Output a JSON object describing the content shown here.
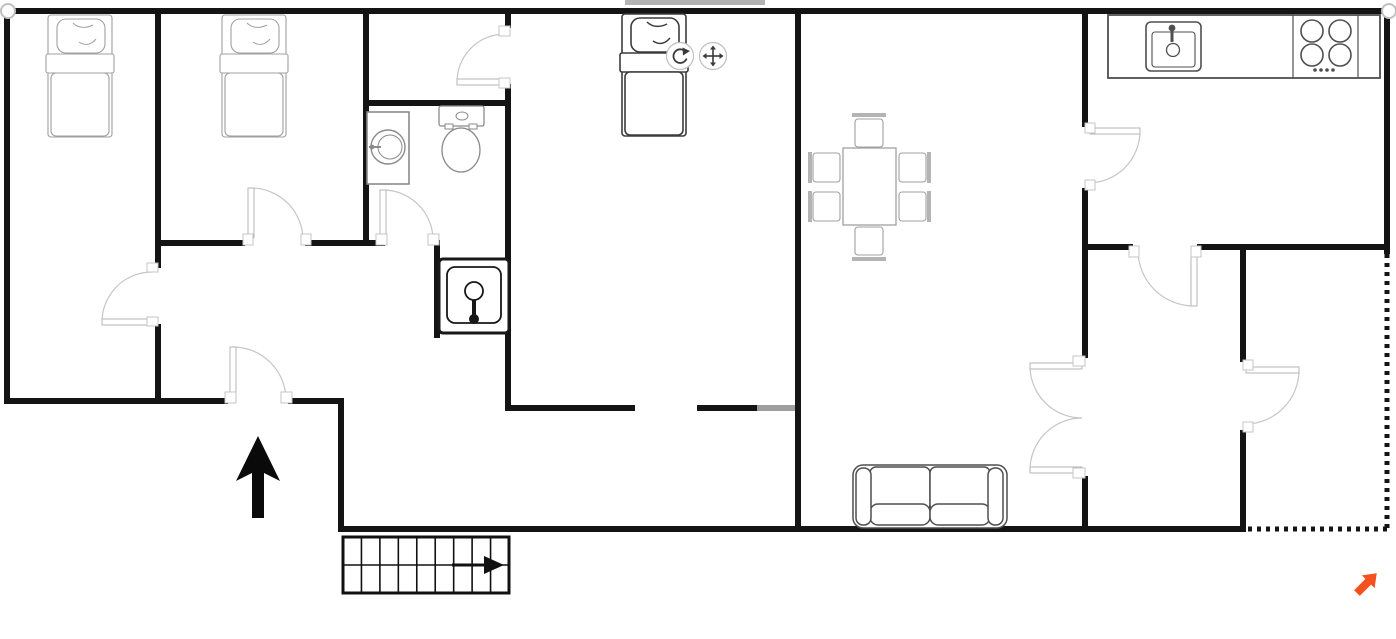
{
  "canvas": {
    "width": 1396,
    "height": 639,
    "bg": "#ffffff"
  },
  "colors": {
    "wall": "#141414",
    "wall_opening_tint": "#9e9e9e",
    "selected_bar_tint": "#b3b3b3",
    "door_arc": "#c6c6c6",
    "door_leaf_stroke": "#b5b5b5",
    "jamb_stroke": "#c4c4c4",
    "furniture_light": "#a0a0a0",
    "furniture_mid": "#8a8a8a",
    "furniture_dark": "#4f4f4f",
    "chair_back_fill": "#b4b4b4",
    "selected_stroke": "#3c3c3c",
    "dark_item": "#181818",
    "stairs": "#111111",
    "north": "#0a0a0a",
    "handle_stroke": "#c0c0c0",
    "icon_glyph": "#3a3a3a",
    "accent_orange": "#f4511e",
    "white": "#ffffff"
  },
  "walls": {
    "solid": [
      [
        4,
        8,
        1388,
        6
      ],
      [
        4,
        8,
        6,
        396
      ],
      [
        4,
        398,
        224,
        6
      ],
      [
        288,
        398,
        56,
        6
      ],
      [
        338,
        398,
        6,
        134
      ],
      [
        338,
        526,
        908,
        6
      ],
      [
        1384,
        8,
        6,
        246
      ],
      [
        155,
        8,
        6,
        260
      ],
      [
        155,
        324,
        6,
        80
      ],
      [
        155,
        240,
        90,
        6
      ],
      [
        305,
        240,
        63,
        6
      ],
      [
        363,
        8,
        6,
        238
      ],
      [
        363,
        100,
        148,
        6
      ],
      [
        505,
        8,
        6,
        20
      ],
      [
        505,
        84,
        6,
        327
      ],
      [
        363,
        240,
        22,
        6
      ],
      [
        434,
        240,
        6,
        98
      ],
      [
        505,
        405,
        130,
        6
      ],
      [
        697,
        405,
        60,
        6
      ],
      [
        795,
        8,
        6,
        524
      ],
      [
        1082,
        8,
        6,
        119
      ],
      [
        1082,
        188,
        6,
        170
      ],
      [
        1082,
        476,
        6,
        56
      ],
      [
        1082,
        244,
        51,
        6
      ],
      [
        1197,
        244,
        193,
        6
      ],
      [
        1240,
        244,
        6,
        118
      ],
      [
        1240,
        430,
        6,
        102
      ]
    ],
    "tinted": [
      {
        "rect": [
          757,
          405,
          38,
          6
        ],
        "color": "#9e9e9e"
      },
      {
        "rect": [
          625,
          0,
          140,
          5
        ],
        "color": "#b3b3b3"
      }
    ],
    "dotted": [
      {
        "x1": 1387,
        "y1": 254,
        "x2": 1387,
        "y2": 529
      },
      {
        "x1": 1248,
        "y1": 529,
        "x2": 1392,
        "y2": 529
      }
    ],
    "endpoint_handles": [
      [
        8,
        11
      ],
      [
        1389,
        11
      ]
    ]
  },
  "doors": [
    {
      "id": "door-bedroom-1",
      "leaf": [
        102,
        322,
        152,
        322
      ],
      "arc": {
        "from": [
          102,
          322
        ],
        "to": [
          152,
          272
        ],
        "r": 50,
        "sweep": 1
      },
      "jambs": [
        [
          147,
          263,
          11,
          9
        ],
        [
          147,
          317,
          11,
          9
        ]
      ]
    },
    {
      "id": "door-bedroom-2",
      "leaf": [
        251,
        188,
        251,
        238
      ],
      "arc": {
        "from": [
          251,
          188
        ],
        "to": [
          303,
          240
        ],
        "r": 52,
        "sweep": 1
      },
      "jambs": [
        [
          243,
          234,
          10,
          11
        ],
        [
          301,
          234,
          10,
          11
        ]
      ]
    },
    {
      "id": "door-entrance",
      "leaf": [
        233,
        347,
        233,
        398
      ],
      "arc": {
        "from": [
          233,
          347
        ],
        "to": [
          286,
          400
        ],
        "r": 53,
        "sweep": 1
      },
      "jambs": [
        [
          225,
          392,
          11,
          11
        ],
        [
          281,
          392,
          11,
          11
        ]
      ]
    },
    {
      "id": "door-bathroom",
      "leaf": [
        383,
        190,
        383,
        238
      ],
      "arc": {
        "from": [
          383,
          190
        ],
        "to": [
          433,
          240
        ],
        "r": 50,
        "sweep": 1
      },
      "jambs": [
        [
          376,
          234,
          11,
          11
        ],
        [
          428,
          234,
          11,
          11
        ]
      ]
    },
    {
      "id": "door-closet",
      "leaf": [
        457,
        82,
        504,
        82
      ],
      "arc": {
        "from": [
          457,
          82
        ],
        "to": [
          505,
          34
        ],
        "r": 48,
        "sweep": 1
      },
      "jambs": [
        [
          499,
          26,
          11,
          10
        ],
        [
          499,
          78,
          11,
          10
        ]
      ]
    },
    {
      "id": "door-kitchen",
      "leaf": [
        1090,
        131,
        1140,
        131
      ],
      "arc": {
        "from": [
          1140,
          131
        ],
        "to": [
          1088,
          183
        ],
        "r": 52,
        "sweep": 1
      },
      "jambs": [
        [
          1085,
          123,
          10,
          10
        ],
        [
          1085,
          180,
          10,
          10
        ]
      ]
    },
    {
      "id": "door-room-right",
      "leaf": [
        1194,
        252,
        1194,
        306
      ],
      "arc": {
        "from": [
          1194,
          306
        ],
        "to": [
          1138,
          252
        ],
        "r": 56,
        "sweep": 1
      },
      "jambs": [
        [
          1129,
          246,
          10,
          11
        ],
        [
          1191,
          246,
          10,
          11
        ]
      ]
    },
    {
      "id": "door-balcony",
      "leaf": [
        1246,
        370,
        1299,
        370
      ],
      "arc": {
        "from": [
          1299,
          370
        ],
        "to": [
          1246,
          424
        ],
        "r": 54,
        "sweep": 1
      },
      "jambs": [
        [
          1243,
          360,
          10,
          10
        ],
        [
          1243,
          422,
          10,
          10
        ]
      ]
    },
    {
      "id": "french-door-top",
      "leaf": [
        1030,
        366,
        1082,
        366
      ],
      "arc": {
        "from": [
          1030,
          366
        ],
        "to": [
          1082,
          418
        ],
        "r": 52,
        "sweep": 0
      },
      "jambs": [
        [
          1073,
          356,
          12,
          10
        ]
      ]
    },
    {
      "id": "french-door-bottom",
      "leaf": [
        1030,
        470,
        1082,
        470
      ],
      "arc": {
        "from": [
          1030,
          470
        ],
        "to": [
          1082,
          418
        ],
        "r": 52,
        "sweep": 1
      },
      "jambs": [
        [
          1073,
          468,
          12,
          10
        ]
      ]
    }
  ],
  "furniture": {
    "bed_size": {
      "w": 64,
      "h": 122
    },
    "beds": [
      {
        "id": "bed-1",
        "x": 48,
        "y": 15,
        "selected": false
      },
      {
        "id": "bed-2",
        "x": 222,
        "y": 15,
        "selected": false
      },
      {
        "id": "bed-3",
        "x": 622,
        "y": 14,
        "selected": true
      }
    ],
    "washing_machine": {
      "box": [
        367,
        112,
        42,
        72
      ],
      "drum_c": [
        388,
        147
      ],
      "drum_r": 17,
      "drum_inner_r": 12,
      "handle": [
        369,
        147,
        381,
        147
      ]
    },
    "toilet": {
      "tank": [
        439,
        106,
        45,
        20
      ],
      "flush_c": [
        462,
        116
      ],
      "flush_r": [
        6,
        4
      ],
      "bowl_c": [
        461,
        150
      ],
      "bowl_r": [
        19,
        22
      ],
      "hinges": [
        [
          445,
          124,
          8,
          5
        ],
        [
          469,
          124,
          8,
          5
        ]
      ]
    },
    "utility_sink": {
      "outer": [
        439,
        259,
        70,
        74
      ],
      "inner": [
        447,
        267,
        54,
        56
      ],
      "drain_c": [
        474,
        291
      ],
      "drain_r": 9,
      "faucet": [
        474,
        300,
        474,
        319
      ],
      "faucet_tip_r": 5
    },
    "kitchen_counter": {
      "outer": [
        1108,
        15,
        272,
        63
      ],
      "dividers": [
        1293,
        1358
      ],
      "sink_outer": [
        1146,
        22,
        55,
        49
      ],
      "sink_inner": [
        1152,
        32,
        43,
        35
      ],
      "faucet_dot": [
        1172,
        28
      ],
      "faucet_stem": [
        1172,
        30,
        1172,
        42
      ],
      "drain": [
        1173,
        50,
        6.5
      ],
      "burners": [
        [
          1312,
          31
        ],
        [
          1340,
          31
        ],
        [
          1312,
          55
        ],
        [
          1340,
          55
        ]
      ],
      "burner_r": 11,
      "knob_dots_x": [
        1315,
        1321,
        1327,
        1333
      ],
      "knob_dots_y": 70
    },
    "dining_table": {
      "rect": [
        843,
        148,
        53,
        77
      ]
    },
    "chairs": {
      "seats": [
        [
          855,
          119,
          28,
          28
        ],
        [
          855,
          227,
          28,
          28
        ],
        [
          813,
          153,
          27,
          29
        ],
        [
          813,
          192,
          27,
          29
        ],
        [
          899,
          153,
          27,
          29
        ],
        [
          899,
          192,
          27,
          29
        ]
      ],
      "backs": [
        [
          852,
          113,
          34,
          4
        ],
        [
          852,
          257,
          34,
          4
        ],
        [
          808,
          152,
          4,
          31
        ],
        [
          808,
          191,
          4,
          31
        ],
        [
          927,
          152,
          4,
          31
        ],
        [
          927,
          191,
          4,
          31
        ]
      ]
    },
    "sofa": {
      "outer": [
        853,
        465,
        154,
        63
      ],
      "arms": [
        [
          856,
          468,
          15,
          57
        ],
        [
          988,
          468,
          15,
          57
        ]
      ],
      "backs": [
        [
          870,
          467,
          60,
          44
        ],
        [
          930,
          467,
          60,
          44
        ]
      ],
      "seats": [
        [
          870,
          504,
          60,
          21
        ],
        [
          930,
          504,
          60,
          21
        ]
      ]
    },
    "stairs": {
      "outer": [
        343,
        537,
        166,
        56
      ],
      "tread_dividers": 8,
      "mid_y": 565,
      "arrow_shaft": [
        452,
        565,
        484,
        565
      ],
      "arrow_head": "484,556 484,574 504,565"
    }
  },
  "annotations": {
    "north_arrow": {
      "points": "258,436 280,481 264,473 264,518 252,518 252,473 236,481"
    },
    "selection_handles": {
      "rotate": {
        "cx": 680,
        "cy": 56,
        "r": 13.5
      },
      "move": {
        "cx": 713,
        "cy": 56,
        "r": 13.5
      }
    },
    "orange_pointer": {
      "cx": 1364,
      "cy": 586
    }
  }
}
